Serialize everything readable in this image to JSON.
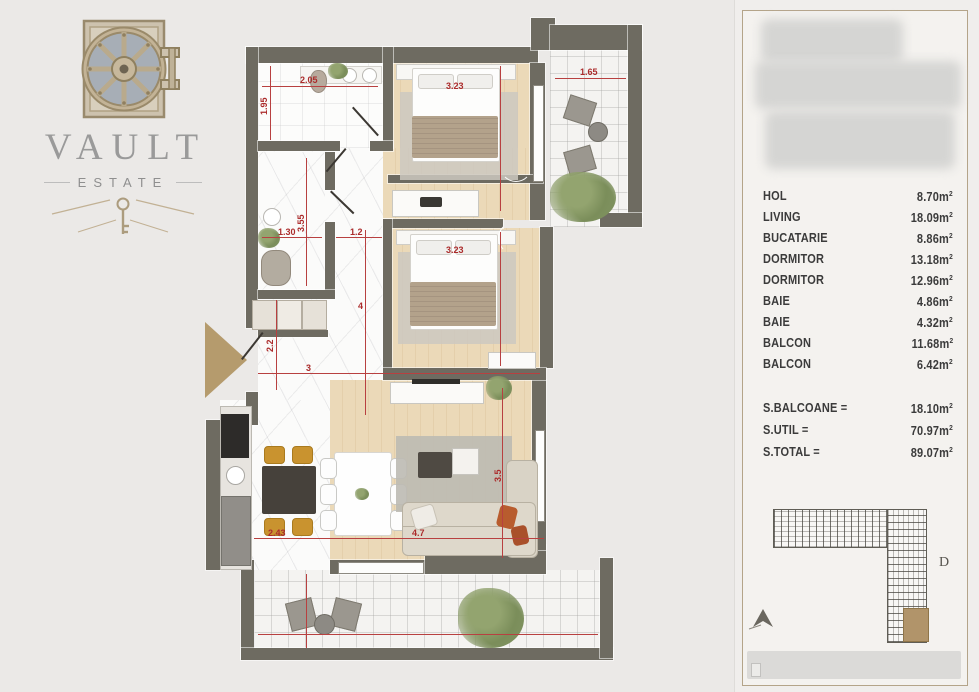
{
  "brand": {
    "name": "VAULT",
    "sub": "ESTATE"
  },
  "plan": {
    "dims": {
      "bath1_w": "2.05",
      "bath1_h": "1.95",
      "balc1_w": "1.65",
      "bed1_w": "3.23",
      "bath2_h": "3.55",
      "bath2_w": "1.30",
      "corridor_w": "1.2",
      "hall_h": "4",
      "hall_left": "2.2",
      "hall_w": "3",
      "kitchen_w": "2.43",
      "living_w": "4.7",
      "living_h": "3.5",
      "bed2_w": "3.23"
    }
  },
  "panel": {
    "unit_base": "m",
    "unit_exp": "2",
    "rooms": [
      {
        "name": "HOL",
        "area": "8.70"
      },
      {
        "name": "LIVING",
        "area": "18.09"
      },
      {
        "name": "BUCATARIE",
        "area": "8.86"
      },
      {
        "name": "DORMITOR",
        "area": "13.18"
      },
      {
        "name": "DORMITOR",
        "area": "12.96"
      },
      {
        "name": "BAIE",
        "area": "4.86"
      },
      {
        "name": "BAIE",
        "area": "4.32"
      },
      {
        "name": "BALCON",
        "area": "11.68"
      },
      {
        "name": "BALCON",
        "area": "6.42"
      }
    ],
    "totals": [
      {
        "label": "S.BALCOANE =",
        "value": "18.10"
      },
      {
        "label": "S.UTIL =",
        "value": "70.97"
      },
      {
        "label": "S.TOTAL =",
        "value": "89.07"
      }
    ],
    "keyplan": {
      "block_label": "D"
    }
  }
}
